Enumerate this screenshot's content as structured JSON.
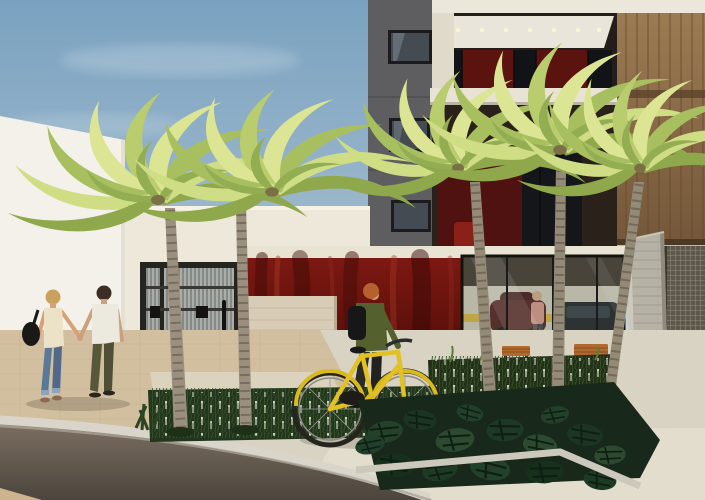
{
  "scene": {
    "title": "Street-level architectural render of a modern apartment building entrance with palm trees",
    "signage": {
      "plaza_sign": "ZA BOTEGUIN",
      "house_number": "40"
    },
    "elements": [
      "sky",
      "neighboring-white-building",
      "apartment-tower",
      "upper-balconies",
      "wood-facade-panel",
      "entrance-parapet",
      "pedestrian-gate",
      "red-feature-wall",
      "stone-sign-panel",
      "glass-garage-facade",
      "parked-cars",
      "garage-visitor",
      "wooden-benches",
      "concrete-pier",
      "perforated-screen",
      "palm-trees",
      "planting-bed-left",
      "planting-bed-right",
      "monstera-planter",
      "sidewalk",
      "driveway",
      "street",
      "curb",
      "walking-couple",
      "person-pushing-bicycle",
      "yellow-bicycle"
    ],
    "palette": {
      "sky_top": "#7aa2c0",
      "sky_horizon": "#dde2e2",
      "neighbor_white": "#f4f1ea",
      "tower_gray": "#5e5d60",
      "wood_facade": "#8a6a45",
      "feature_wall_red": "#6e1410",
      "stone_band": "#d8ccb7",
      "gate_metal": "#26241f",
      "bicycle_yellow": "#e2c122",
      "palm_light": "#dce594",
      "palm_dark": "#a8bf60",
      "planting_green": "#22351d",
      "sidewalk_beige": "#d2bf9f",
      "asphalt": "#4c453d",
      "curb_white": "#d9d5ca"
    }
  }
}
